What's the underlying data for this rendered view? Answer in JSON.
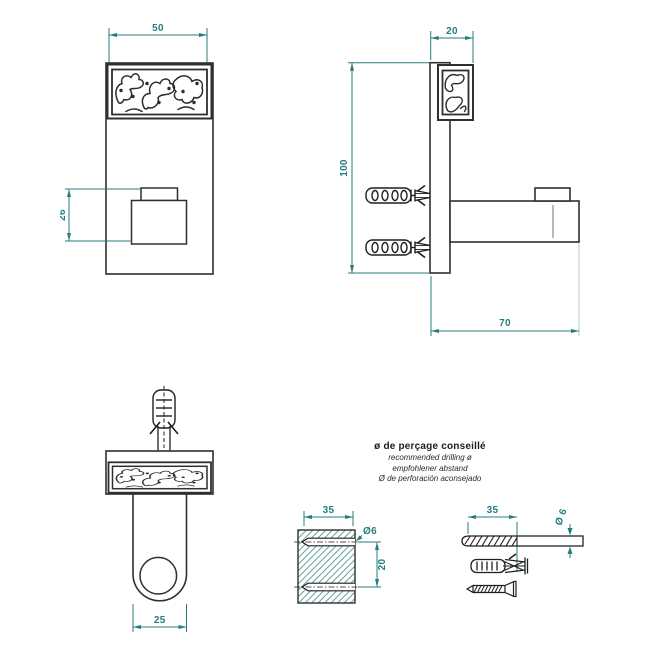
{
  "colors": {
    "dimension_teal": "#257d7d",
    "drawing_line": "#2f2f2f",
    "hatch_teal": "#69a2a2",
    "light_extension": "#b7ced4"
  },
  "front_view": {
    "width_mm": "50",
    "hook_offset_mm": "26"
  },
  "side_view": {
    "plate_depth_mm": "20",
    "height_mm": "100",
    "projection_mm": "70"
  },
  "top_view": {
    "arm_width_mm": "25"
  },
  "drilling_note": {
    "title_fr": "ø de perçage conseillé",
    "line_en": "recommended drilling ø",
    "line_de": "empfohlener abstand",
    "line_es": "Ø de perforación aconsejado"
  },
  "wall_section": {
    "drill_depth_mm": "35",
    "hole_spacing_mm": "20",
    "hole_diameter": "Ø6"
  },
  "hardware": {
    "drill_flute_length_mm": "35",
    "drill_diameter": "Ø 6"
  }
}
